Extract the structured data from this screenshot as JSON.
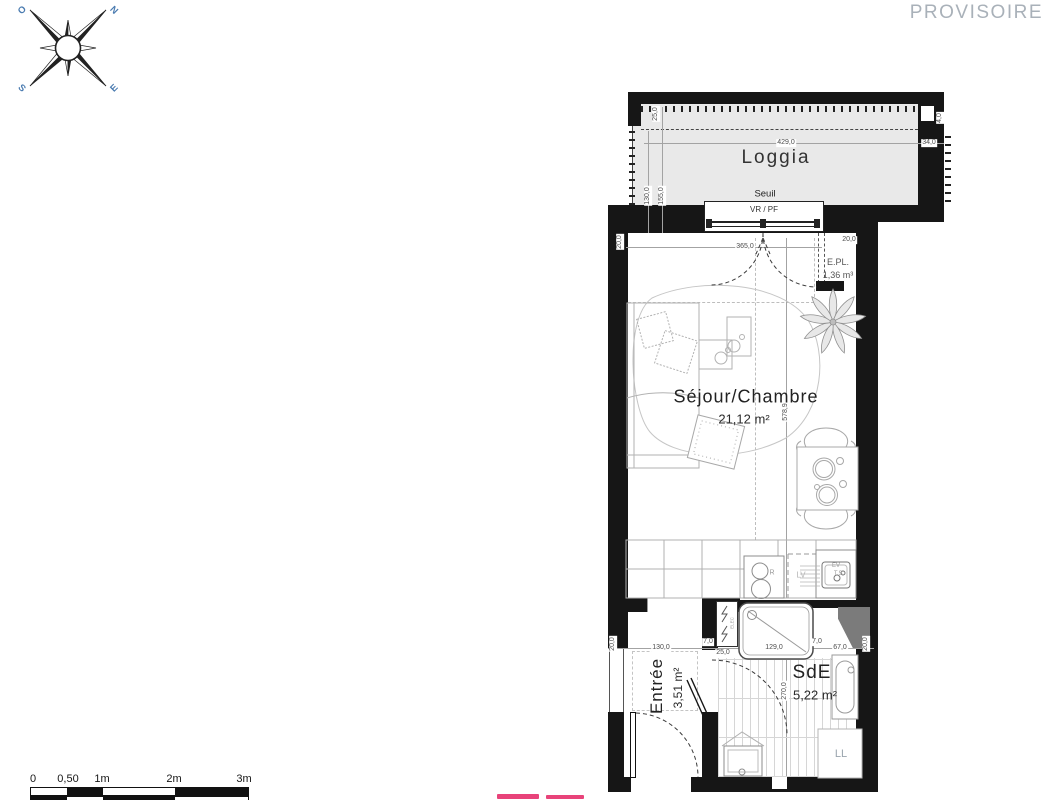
{
  "watermark": {
    "text": "PROVISOIRE",
    "color": "#a9b1b9"
  },
  "compass": {
    "nw": "O",
    "ne": "N",
    "sw": "S",
    "se": "E",
    "letter_color": "#4a7bb0"
  },
  "rooms": {
    "loggia": {
      "name": "Loggia"
    },
    "sejour": {
      "name": "Séjour/Chambre",
      "area": "21,12 m²"
    },
    "entree": {
      "name": "Entrée",
      "area": "3,51 m²"
    },
    "sde": {
      "name": "SdE",
      "area": "5,22 m²"
    },
    "placard": {
      "name": "E.PL.",
      "volume": "1,36 m³"
    }
  },
  "annotations": {
    "seuil": "Seuil",
    "vr_pf": "VR / PF",
    "elec": "ELEC",
    "washer": "LL",
    "dishwasher": "LV",
    "sink_ev": "EV",
    "sink_ts": "T.S.",
    "fridge": "R"
  },
  "dimensions": {
    "d25": "25,0",
    "d130": "130,0",
    "d155": "155,0",
    "d429": "429,0",
    "d34": "34,0",
    "d4": "4,0",
    "d365": "365,0",
    "d20": "20,0",
    "d578": "578,9",
    "d7": "7,0",
    "d129": "129,0",
    "d67": "67,0",
    "d270": "270,0"
  },
  "scale_bar": {
    "t0": "0",
    "t1": "0,50",
    "t2": "1m",
    "t3": "2m",
    "t4": "3m"
  }
}
